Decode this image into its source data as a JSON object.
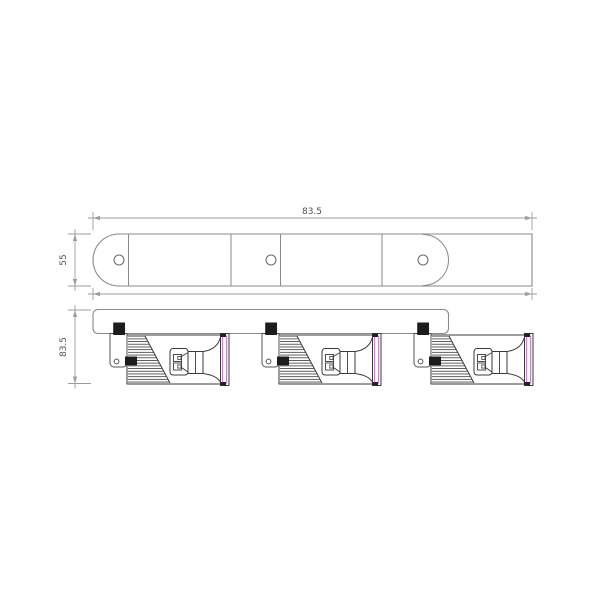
{
  "drawing": {
    "kind": "technical dimension drawing",
    "views": {
      "top_view": {
        "mounting_hole_count": 3,
        "panel_divider_count": 4
      },
      "front_view": {
        "spotlight_head_count": 3
      }
    },
    "dimensions": {
      "top_length_label": "83.5",
      "top_height_label": "55",
      "front_height_label": "83.5"
    },
    "colors": {
      "background": "#ffffff",
      "outline_dark": "#3a3a3a",
      "outline_gray": "#8a8a8a",
      "dimension_gray": "#9c9c9c",
      "label_text": "#4f4f4f",
      "lens_accent_magenta": "#c487c4",
      "knob_black": "#1c1c1c"
    }
  }
}
